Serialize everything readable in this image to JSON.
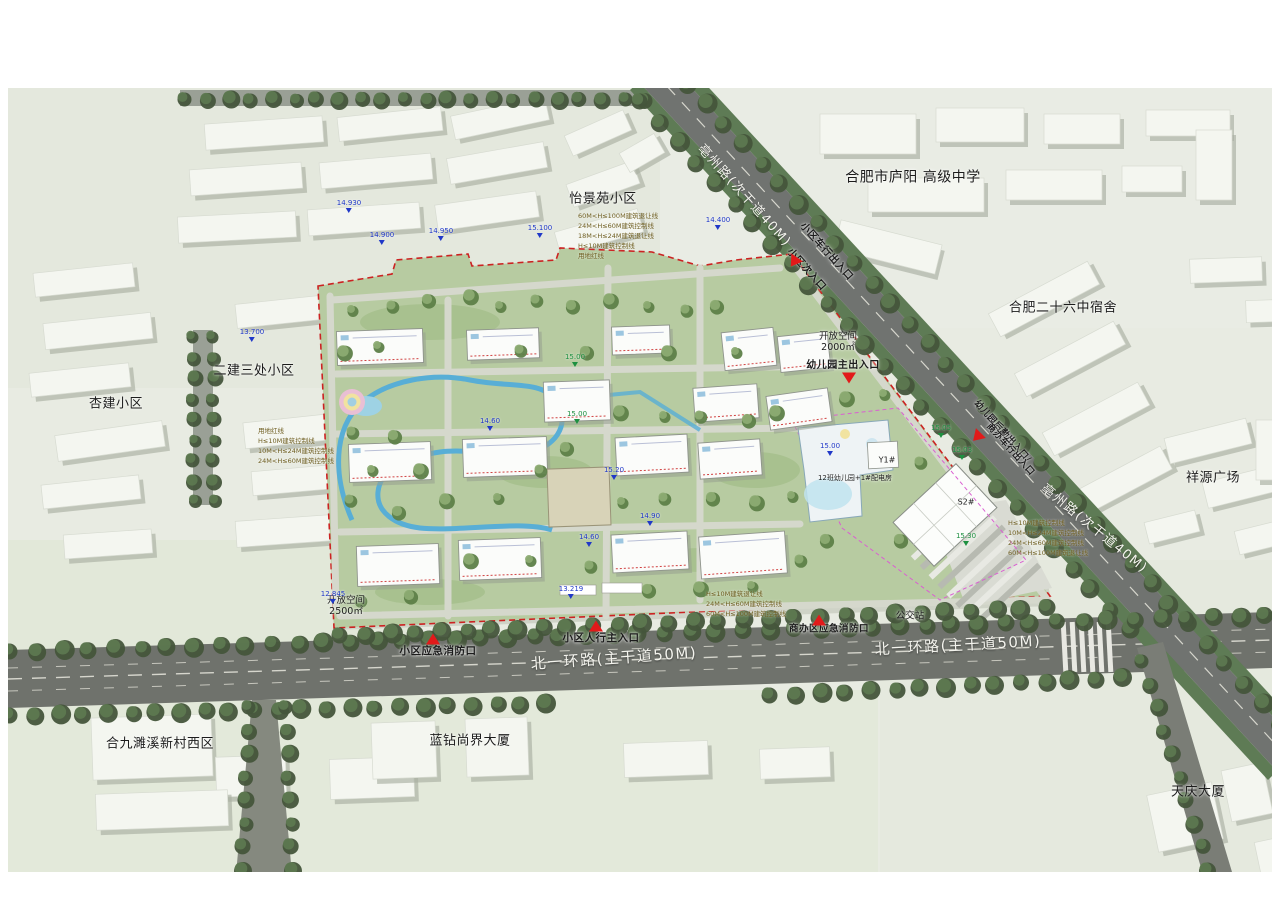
{
  "colors": {
    "map_bg": "#e8ebe2",
    "road_major": "#6f726c",
    "road_minor": "#9aa096",
    "street_tree": "#50694a",
    "site_green": "#b7cba1",
    "water": "#58aed6",
    "building_white": "#f4f6f0",
    "red_marker": "#e21a1a",
    "boundary_red": "#cc2222",
    "elevation_blue": "#2038c8",
    "elevation_green": "#1d9040",
    "setback_text": "#6e5e20",
    "label_black": "#1c1c1c",
    "road_label_white": "#f4f4ee"
  },
  "road_labels": [
    {
      "id": "bozhou-road-label-top",
      "text": "亳州路(次干道40M)",
      "x": 744,
      "y": 196,
      "rot": 48,
      "size": 13
    },
    {
      "id": "bozhou-road-label-right",
      "text": "亳州路(次干道40M)",
      "x": 1094,
      "y": 529,
      "rot": 39,
      "size": 13
    },
    {
      "id": "beiyihuan-road-label-left",
      "text": "北一环路(主干道50M)",
      "x": 614,
      "y": 659,
      "rot": -4,
      "size": 15
    },
    {
      "id": "beiyihuan-road-label-right",
      "text": "北一环路(主干道50M)",
      "x": 958,
      "y": 646,
      "rot": -3,
      "size": 15
    }
  ],
  "neighborhood_labels": [
    {
      "id": "label-yijingyuan",
      "text": "怡景苑小区",
      "x": 603,
      "y": 199,
      "size": 13
    },
    {
      "id": "label-luyang-school",
      "text": "合肥市庐阳 高级中学",
      "x": 913,
      "y": 178,
      "size": 14
    },
    {
      "id": "label-no26-dorm",
      "text": "合肥二十六中宿舍",
      "x": 1063,
      "y": 308,
      "size": 13
    },
    {
      "id": "label-xiangyuan-plaza",
      "text": "祥源广场",
      "x": 1213,
      "y": 478,
      "size": 13
    },
    {
      "id": "label-erjian-sanchu",
      "text": "二建三处小区",
      "x": 254,
      "y": 371,
      "size": 13
    },
    {
      "id": "label-xingjian",
      "text": "杏建小区",
      "x": 116,
      "y": 404,
      "size": 13
    },
    {
      "id": "label-hejiu-suixi-west",
      "text": "合九濉溪新村西区",
      "x": 160,
      "y": 744,
      "size": 13
    },
    {
      "id": "label-lanzuan-tower",
      "text": "蓝钻尚界大厦",
      "x": 470,
      "y": 741,
      "size": 13
    },
    {
      "id": "label-tianqing-tower",
      "text": "天庆大厦",
      "x": 1198,
      "y": 792,
      "size": 13
    }
  ],
  "entrance_labels": [
    {
      "id": "label-vehicle-entrance-north",
      "text": "小区车行出入口",
      "x": 826,
      "y": 252,
      "rot": 48,
      "size": 10
    },
    {
      "id": "label-secondary-entrance-north",
      "text": "小区次入口",
      "x": 806,
      "y": 270,
      "rot": 48,
      "size": 10
    },
    {
      "id": "label-kindergarten-main-entrance",
      "text": "幼儿园主出入口",
      "x": 843,
      "y": 366,
      "rot": 0,
      "size": 10
    },
    {
      "id": "label-kindergarten-service-entrance",
      "text": "幼儿园后勤出入口/",
      "x": 1002,
      "y": 432,
      "rot": 48,
      "size": 9
    },
    {
      "id": "label-office-vehicle-entrance",
      "text": "商办车行出入口",
      "x": 1010,
      "y": 450,
      "rot": 48,
      "size": 9
    },
    {
      "id": "label-pedestrian-main-entrance",
      "text": "小区人行主入口",
      "x": 601,
      "y": 638,
      "rot": 0,
      "size": 10.5
    },
    {
      "id": "label-emergency-fire-exit",
      "text": "小区应急消防口",
      "x": 438,
      "y": 651,
      "rot": 0,
      "size": 10.5
    },
    {
      "id": "label-office-emergency-fire-exit",
      "text": "商办区应急消防口",
      "x": 829,
      "y": 629,
      "rot": 0,
      "size": 9.5
    }
  ],
  "entrance_markers": [
    {
      "id": "marker-vehicle-entrance-north",
      "x": 794,
      "y": 262,
      "rot": 215
    },
    {
      "id": "marker-kindergarten-main-entrance",
      "x": 849,
      "y": 378,
      "rot": 180
    },
    {
      "id": "marker-kindergarten-service-entrance",
      "x": 977,
      "y": 437,
      "rot": 225
    },
    {
      "id": "marker-pedestrian-main-entrance",
      "x": 596,
      "y": 626,
      "rot": 0
    },
    {
      "id": "marker-emergency-fire-exit",
      "x": 433,
      "y": 639,
      "rot": 0
    },
    {
      "id": "marker-office-emergency-fire-exit",
      "x": 819,
      "y": 620,
      "rot": 0
    }
  ],
  "poi_labels": [
    {
      "id": "label-bus-station",
      "text": "公交站",
      "x": 910,
      "y": 616,
      "size": 9.5
    },
    {
      "id": "label-open-space-2500",
      "text": "开放空间\n2500㎡",
      "x": 346,
      "y": 606,
      "size": 9.5
    },
    {
      "id": "label-open-space-2000",
      "text": "开放空间\n2000㎡",
      "x": 838,
      "y": 342,
      "size": 9.5
    },
    {
      "id": "label-kindergarten-12-class",
      "text": "12班幼儿园+1#配电房",
      "x": 855,
      "y": 478,
      "size": 7
    },
    {
      "id": "label-building-y1",
      "text": "Y1#",
      "x": 887,
      "y": 460,
      "size": 8
    },
    {
      "id": "label-building-s2",
      "text": "S2#",
      "x": 966,
      "y": 502,
      "size": 8
    }
  ],
  "setback_stacks": [
    {
      "id": "setback-stack-west",
      "x": 258,
      "y": 446,
      "lines": [
        "用地红线",
        "H≤10M建筑控制线",
        "10M<H≤24M建筑控制线",
        "24M<H≤60M建筑控制线"
      ]
    },
    {
      "id": "setback-stack-north",
      "x": 578,
      "y": 236,
      "lines": [
        "60M<H≤100M建筑退让线",
        "24M<H≤60M建筑控制线",
        "18M<H≤24M建筑退让线",
        "H≤10M建筑控制线",
        "用地红线"
      ]
    },
    {
      "id": "setback-stack-east",
      "x": 1008,
      "y": 538,
      "lines": [
        "H≤10M建筑控制线",
        "10M<H≤24M建筑控制线",
        "24M<H≤60M建筑控制线",
        "60M<H≤100M建筑退让线"
      ]
    },
    {
      "id": "setback-stack-south",
      "x": 706,
      "y": 604,
      "lines": [
        "H≤10M建筑退让线",
        "24M<H≤60M建筑控制线",
        "60M<H≤100M建筑控制线"
      ]
    }
  ],
  "elevation_markers": [
    {
      "value": "13.700",
      "x": 252,
      "y": 342,
      "color": "blue"
    },
    {
      "value": "14.930",
      "x": 349,
      "y": 213,
      "color": "blue"
    },
    {
      "value": "14.900",
      "x": 382,
      "y": 245,
      "color": "blue"
    },
    {
      "value": "14.950",
      "x": 441,
      "y": 241,
      "color": "blue"
    },
    {
      "value": "15.100",
      "x": 540,
      "y": 238,
      "color": "blue"
    },
    {
      "value": "14.400",
      "x": 718,
      "y": 230,
      "color": "blue"
    },
    {
      "value": "12.845",
      "x": 333,
      "y": 604,
      "color": "blue"
    },
    {
      "value": "13.219",
      "x": 571,
      "y": 599,
      "color": "blue"
    },
    {
      "value": "15.00",
      "x": 575,
      "y": 367,
      "color": "green"
    },
    {
      "value": "15.00",
      "x": 577,
      "y": 424,
      "color": "green"
    },
    {
      "value": "15.20",
      "x": 614,
      "y": 480,
      "color": "blue"
    },
    {
      "value": "14.90",
      "x": 650,
      "y": 526,
      "color": "blue"
    },
    {
      "value": "14.60",
      "x": 589,
      "y": 547,
      "color": "blue"
    },
    {
      "value": "14.60",
      "x": 490,
      "y": 431,
      "color": "blue"
    },
    {
      "value": "15.05",
      "x": 941,
      "y": 438,
      "color": "green"
    },
    {
      "value": "15.03",
      "x": 962,
      "y": 460,
      "color": "green"
    },
    {
      "value": "15.30",
      "x": 966,
      "y": 546,
      "color": "green"
    },
    {
      "value": "15.00",
      "x": 830,
      "y": 456,
      "color": "blue"
    }
  ]
}
